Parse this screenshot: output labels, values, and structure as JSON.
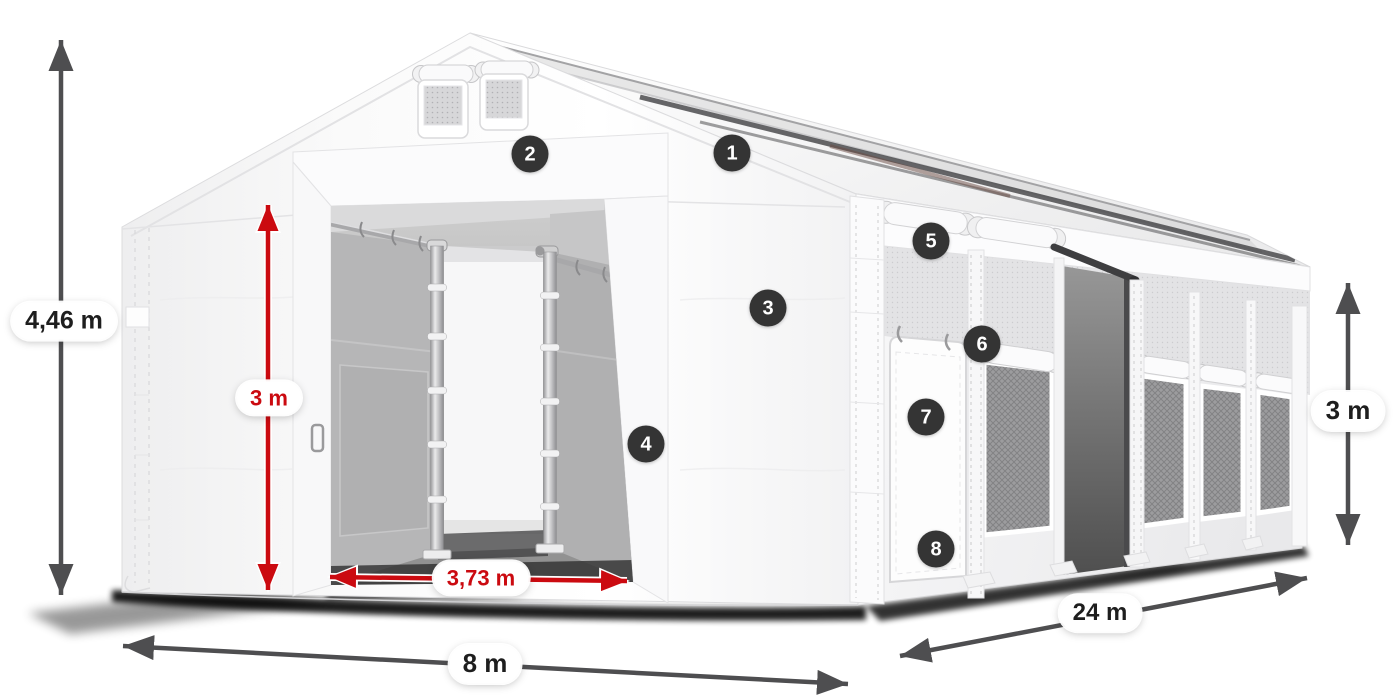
{
  "figure": {
    "description": "Dimension diagram of a white tarpaulin storage tent with open gable doors, mesh side windows and numbered feature callouts"
  },
  "dimensions": {
    "total_height": {
      "value": "4,46 m"
    },
    "door_height": {
      "value": "3 m"
    },
    "door_width": {
      "value": "3,73 m"
    },
    "front_width": {
      "value": "8 m"
    },
    "side_length": {
      "value": "24 m"
    },
    "side_height": {
      "value": "3 m"
    }
  },
  "callouts": [
    {
      "number": "1"
    },
    {
      "number": "2"
    },
    {
      "number": "3"
    },
    {
      "number": "4"
    },
    {
      "number": "5"
    },
    {
      "number": "6"
    },
    {
      "number": "7"
    },
    {
      "number": "8"
    }
  ],
  "colors": {
    "dimension_red": "#cb0a10",
    "dimension_gray": "#4e4e50",
    "badge_background": "#343434",
    "badge_number": "#ffffff",
    "tent_white": "#ffffff"
  }
}
